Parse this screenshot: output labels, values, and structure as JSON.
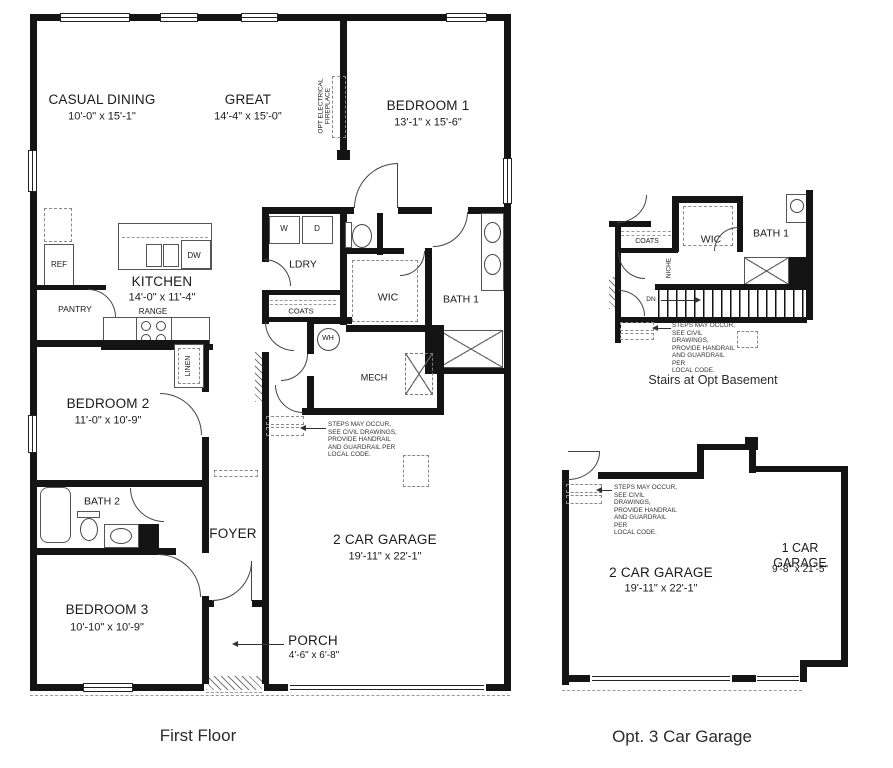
{
  "captions": {
    "first_floor": "First Floor",
    "stairs_detail": "Stairs at Opt Basement",
    "garage_detail": "Opt. 3 Car Garage"
  },
  "first_floor": {
    "casual_dining": {
      "name": "CASUAL DINING",
      "dims": "10'-0\" x 15'-1\""
    },
    "great": {
      "name": "GREAT",
      "dims": "14'-4\" x 15'-0\""
    },
    "bedroom1": {
      "name": "BEDROOM 1",
      "dims": "13'-1\" x 15'-6\""
    },
    "kitchen": {
      "name": "KITCHEN",
      "dims": "14'-0\" x 11'-4\""
    },
    "bedroom2": {
      "name": "BEDROOM 2",
      "dims": "11'-0\" x 10'-9\""
    },
    "bedroom3": {
      "name": "BEDROOM 3",
      "dims": "10'-10\" x 10'-9\""
    },
    "garage": {
      "name": "2 CAR GARAGE",
      "dims": "19'-11\" x 22'-1\""
    },
    "porch": {
      "name": "PORCH",
      "dims": "4'-6\" x 6'-8\""
    },
    "ldry": "LDRY",
    "wic": "WIC",
    "bath1": "BATH 1",
    "bath2": "BATH 2",
    "foyer": "FOYER",
    "mech": "MECH",
    "pantry": "PANTRY",
    "coats": "COATS",
    "linen": "LINEN",
    "ref": "REF",
    "range": "RANGE",
    "dw": "DW",
    "washer": "W",
    "dryer": "D",
    "wh": "WH",
    "fireplace": "OPT ELECTRICAL\nFIREPLACE"
  },
  "stairs": {
    "coats": "COATS",
    "wic": "WIC",
    "bath1": "BATH 1",
    "niche": "NICHE",
    "dn": "DN"
  },
  "garage_opt": {
    "two_car": {
      "name": "2 CAR GARAGE",
      "dims": "19'-11\" x 22'-1\""
    },
    "one_car": {
      "name": "1 CAR GARAGE",
      "dims": "9'-8\" x 21'-5\""
    }
  },
  "notes": {
    "steps": "STEPS MAY OCCUR,\nSEE CIVIL DRAWINGS,\nPROVIDE HANDRAIL\nAND GUARDRAIL PER\nLOCAL CODE."
  }
}
